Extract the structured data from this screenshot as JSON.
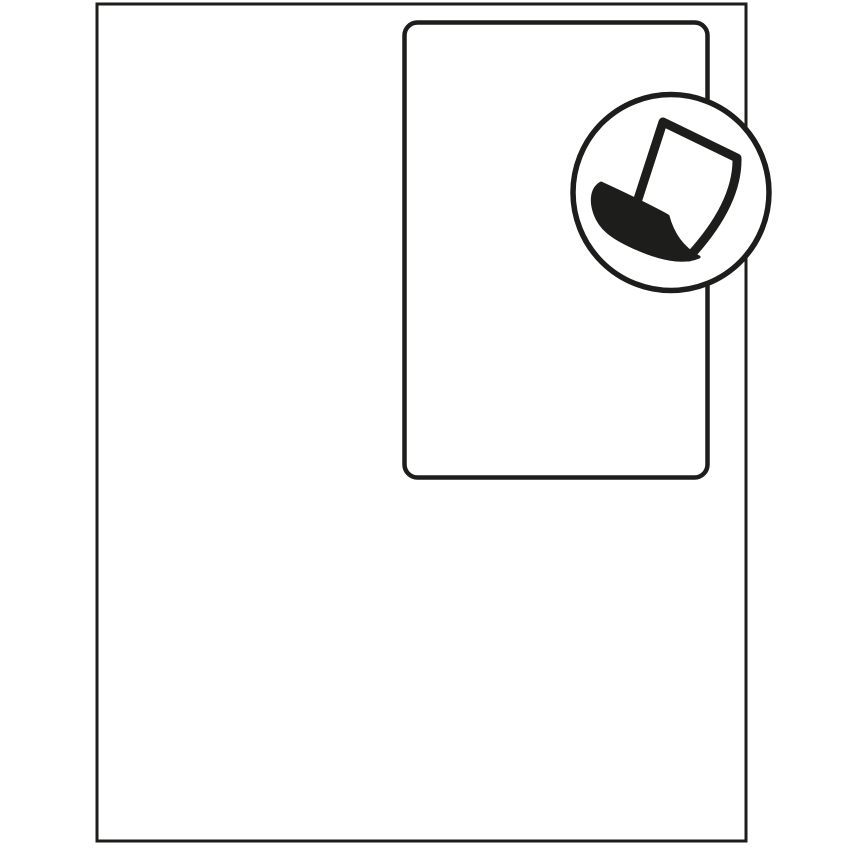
{
  "colors": {
    "background": "#ffffff",
    "line": "#1d1d1b",
    "shape_fill": "#ffffff"
  },
  "illustration": {
    "sheet": {
      "name": "blank-sheet-outline"
    },
    "label": {
      "name": "rounded-label-outline"
    },
    "badge": {
      "icon": "peel-label-icon"
    }
  }
}
